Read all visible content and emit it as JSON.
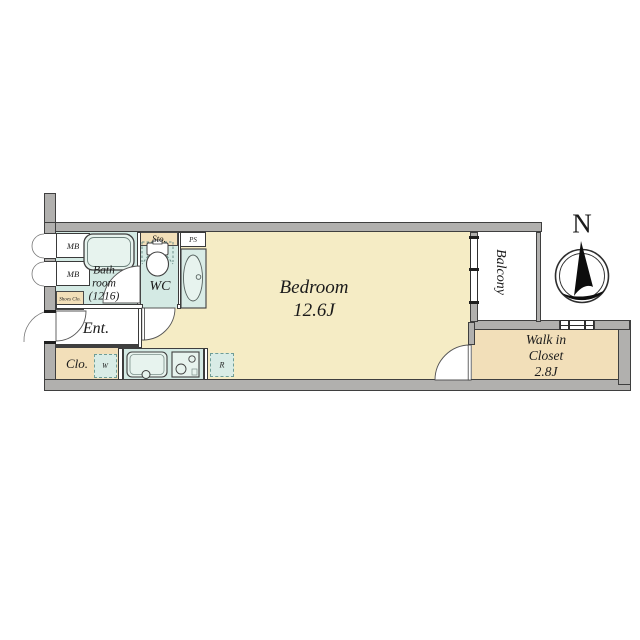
{
  "plan": {
    "bedroom": {
      "name": "Bedroom",
      "size": "12.6J"
    },
    "bathroom": {
      "line1": "Bath",
      "line2": "room",
      "line3": "(1216)"
    },
    "wc": "WC",
    "entrance": "Ent.",
    "closet": "Clo.",
    "storage": "Sto.",
    "pipe_space": "PS",
    "meter_box_1": "MB",
    "meter_box_2": "MB",
    "shoes_closet": "Shoes Clo.",
    "washer_space": "W",
    "fridge_space": "R",
    "balcony": "Balcony",
    "walk_in_closet": {
      "line1": "Walk in",
      "line2": "Closet",
      "size": "2.8J"
    },
    "compass_north": "N"
  },
  "colors": {
    "wall_gray": "#b1b0ae",
    "floor_cream": "#f5ecc5",
    "floor_tan": "#f2dfb9",
    "wet_cyan": "#d4eae4",
    "fixture": "#e7f3ee",
    "line_dark": "#3f3f3f"
  }
}
